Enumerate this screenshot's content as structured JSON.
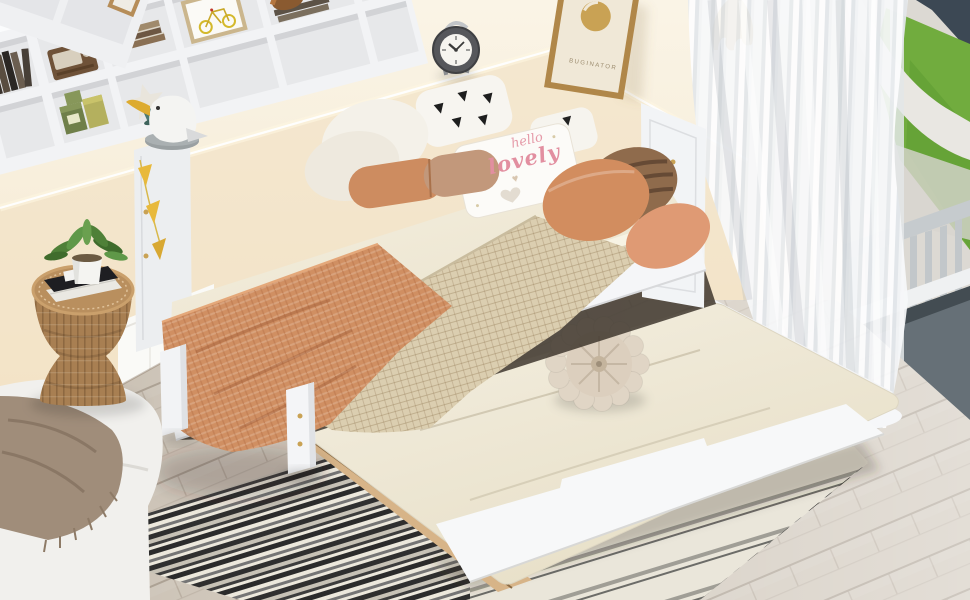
{
  "meta": {
    "type": "product-photo",
    "subject": "Twin daybed with L-shaped bookcase storage headboard, USB charging station and pull-out trundle bed in a styled bedroom"
  },
  "texts": {
    "pillow": {
      "line1": "hello",
      "line2": "lovely",
      "heart": "♥"
    },
    "poster": {
      "brand": "BUGINATOR"
    }
  },
  "palette": {
    "wall_upper": "#f9f2e2",
    "wall_lower": "#f0dfc0",
    "wainscot": "#fafaf7",
    "floor": "#cfc6b9",
    "bed_frame": "#f5f6f8",
    "sheet": "#f0ead9",
    "mattress": "#efe9d8",
    "blanket_terracotta": "#d08f62",
    "blanket_waffle": "#dbceb0",
    "pillow_brown": "#8f6b4c",
    "pillow_orange": "#d28d5f",
    "rug_dark": "#2b2b2b",
    "rug_light": "#ece8dc",
    "curtain": "#f4f5f7",
    "grass": "#71ac3e",
    "railing_base": "#667077",
    "accent_gold": "#c9a254",
    "plant_green": "#4f8038",
    "stool_rattan": "#a87f52"
  },
  "objects": [
    "white daybed with bookcase storage headboard",
    "pull-out trundle bed with cream mattress",
    "black and white striped rug",
    "round pompom floor cushion",
    "hello lovely throw pillow",
    "terracotta and tan pillows",
    "waffle knit blanket",
    "seagull figurine",
    "alarm clock",
    "vintage radio",
    "books",
    "bicycle print",
    "headphones",
    "smartphone on charging dock",
    "USB charging station",
    "starfish ornament",
    "storage tins",
    "photo frames",
    "leaning logo poster",
    "golden monstera wall decals",
    "framed line art",
    "rattan side stool with books and potted plant",
    "white sofa with fringed throw",
    "sheer white curtain",
    "balcony railing and lawn view",
    "light oak laminate floor"
  ]
}
